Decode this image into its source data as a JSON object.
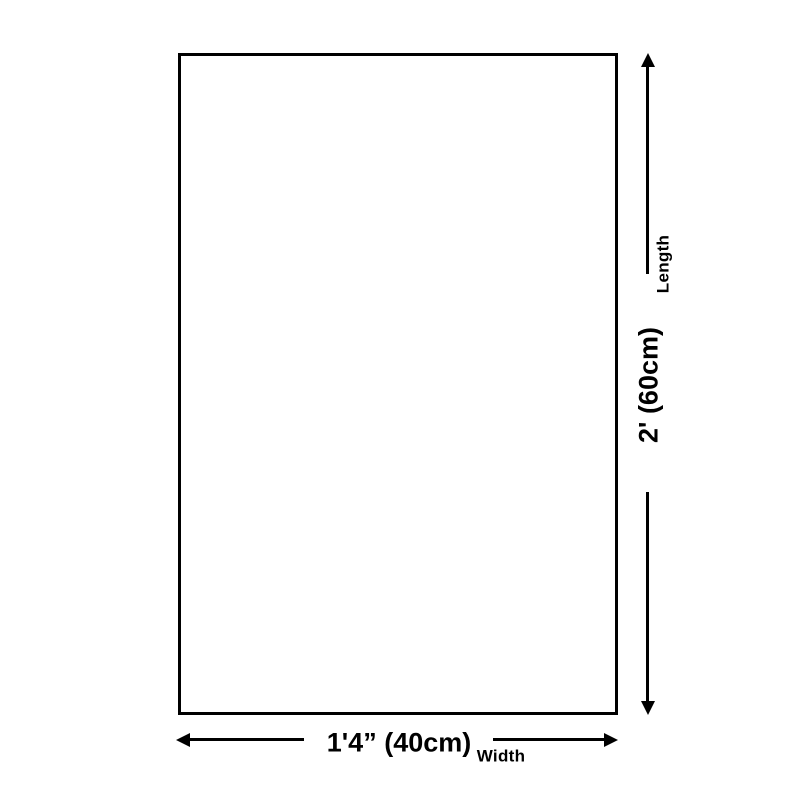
{
  "diagram": {
    "background": "#ffffff",
    "line_color": "#000000",
    "length": {
      "label": "Length",
      "value": "2' (60cm)"
    },
    "width": {
      "label": "Width",
      "value": "1'4” (40cm)"
    }
  }
}
